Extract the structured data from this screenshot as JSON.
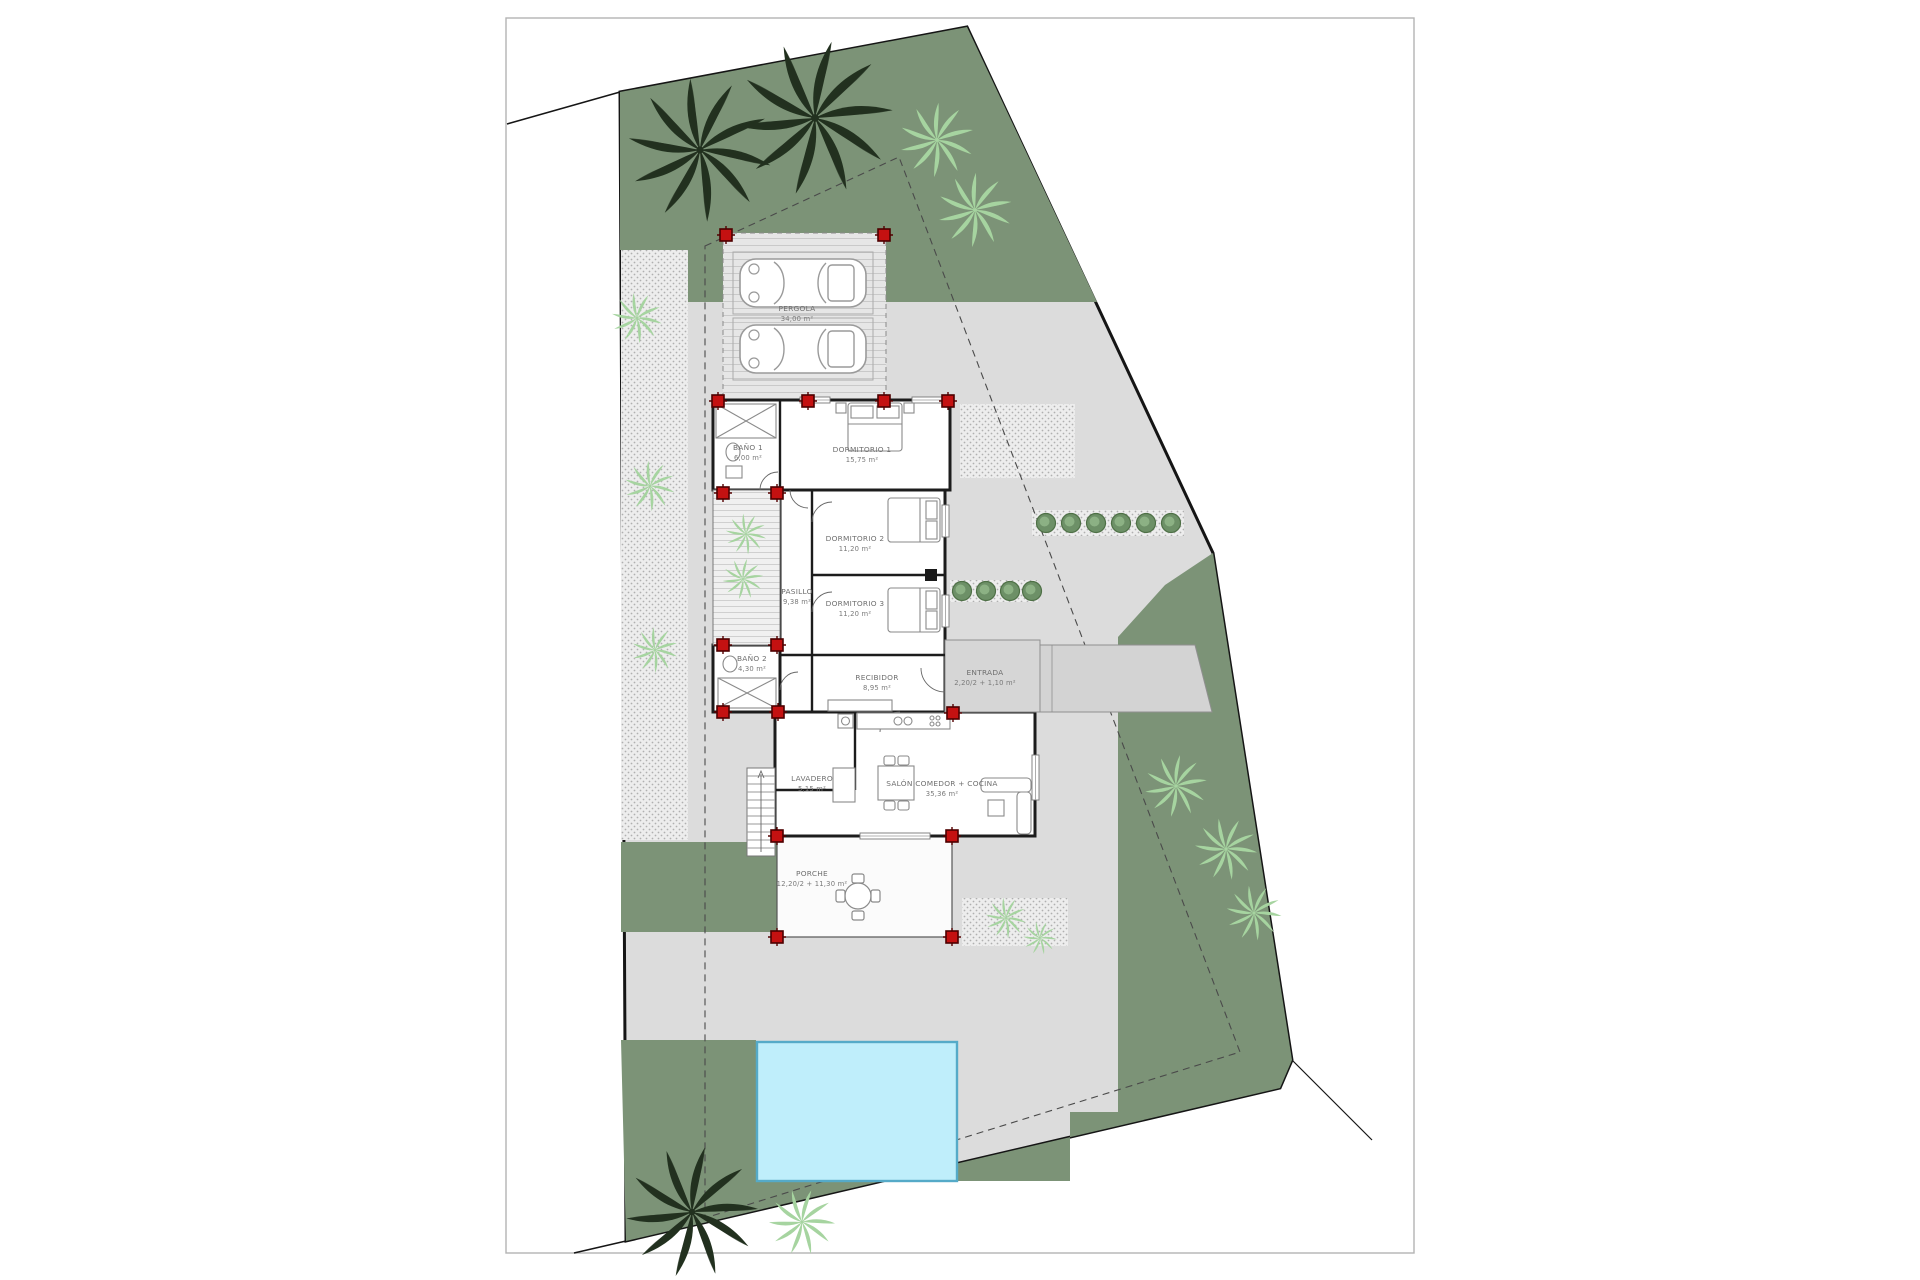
{
  "drawing": {
    "kind": "villa site plan / floor plan",
    "rooms": [
      {
        "name": "PERGOLA",
        "area": "34,00 m²"
      },
      {
        "name": "BAÑO 1",
        "area": "6,00 m²"
      },
      {
        "name": "DORMITORIO 1",
        "area": "15,75 m²"
      },
      {
        "name": "DORMITORIO 2",
        "area": "11,20 m²"
      },
      {
        "name": "PASILLO",
        "area": "9,38 m²"
      },
      {
        "name": "DORMITORIO 3",
        "area": "11,20 m²"
      },
      {
        "name": "BAÑO 2",
        "area": "4,30 m²"
      },
      {
        "name": "RECIBIDOR",
        "area": "8,95 m²"
      },
      {
        "name": "ENTRADA",
        "area": "2,20/2 + 1,10 m²"
      },
      {
        "name": "LAVADERO",
        "area": "5,15 m²"
      },
      {
        "name": "SALÓN COMEDOR + COCINA",
        "area": "35,36 m²"
      },
      {
        "name": "PORCHE",
        "area": "12,20/2 + 11,30 m²"
      }
    ],
    "colors": {
      "garden_green": "#7c9377",
      "terrace_grey": "#dcdcdc",
      "pool_fill": "#bfeefb",
      "pool_border": "#55aac8",
      "column_red": "#c41111",
      "wall_black": "#1c1c1c",
      "gravel_dot": "#b0b0b0",
      "dashed_line": "#4a4a4a"
    },
    "counts": {
      "cars": 2,
      "dark_palms": 3,
      "stair_treads": 11
    }
  }
}
